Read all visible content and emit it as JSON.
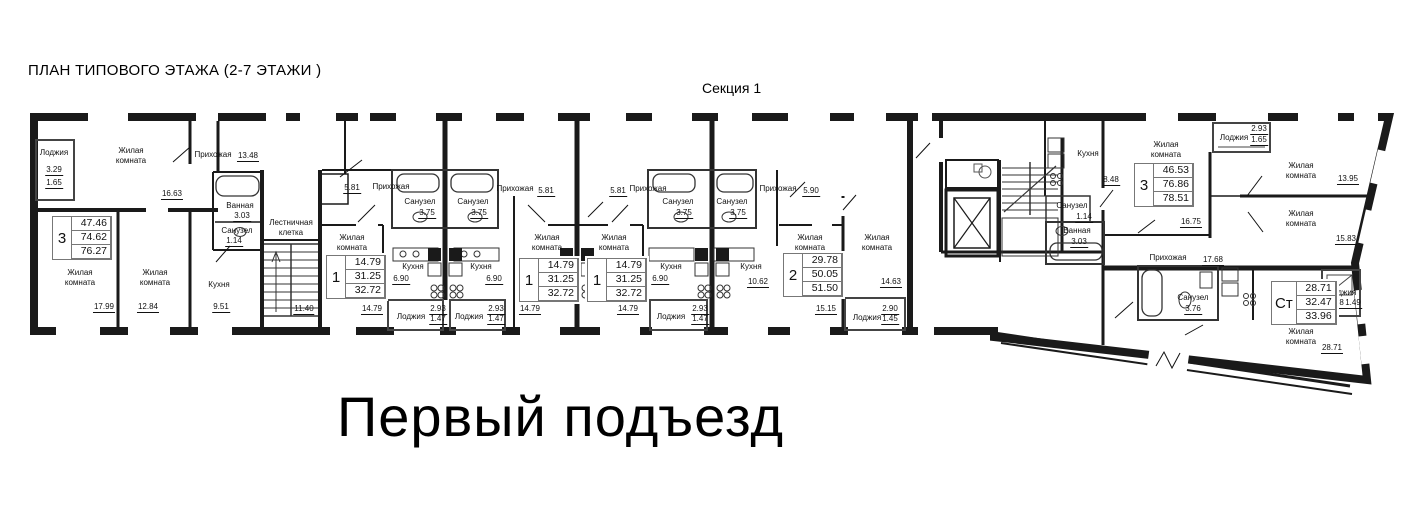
{
  "header": {
    "title": "ПЛАН ТИПОВОГО ЭТАЖА (2-7 ЭТАЖИ )",
    "section_label": "Секция 1"
  },
  "footer": {
    "entrance_label": "Первый подъезд"
  },
  "plan": {
    "rooms": [
      {
        "label": "Лоджия",
        "x": 54,
        "y": 148,
        "area": "3.29",
        "ax": 54,
        "ay": 166,
        "area2": "1.65",
        "a2x": 54,
        "a2y": 179
      },
      {
        "label": "Жилая\nкомната",
        "x": 131,
        "y": 146,
        "area": "16.63",
        "ax": 172,
        "ay": 190
      },
      {
        "label": "Прихожая",
        "x": 213,
        "y": 150,
        "area": "13.48",
        "ax": 248,
        "ay": 152
      },
      {
        "label": "Ванная",
        "x": 240,
        "y": 201,
        "area": "3.03",
        "ax": 242,
        "ay": 212
      },
      {
        "label": "Санузел",
        "x": 237,
        "y": 226,
        "area": "1.14",
        "ax": 234,
        "ay": 237
      },
      {
        "label": "Жилая\nкомната",
        "x": 80,
        "y": 268,
        "area": "17.99",
        "ax": 104,
        "ay": 303
      },
      {
        "label": "Жилая\nкомната",
        "x": 155,
        "y": 268,
        "area": "12.84",
        "ax": 148,
        "ay": 303
      },
      {
        "label": "Кухня",
        "x": 219,
        "y": 280,
        "area": "9.51",
        "ax": 221,
        "ay": 303
      },
      {
        "label": "Лестничная\nклетка",
        "x": 291,
        "y": 218,
        "area": "11.40",
        "ax": 304,
        "ay": 305
      },
      {
        "label": "Прихожая",
        "x": 391,
        "y": 182,
        "area": "5.81",
        "ax": 352,
        "ay": 184
      },
      {
        "label": "Жилая\nкомната",
        "x": 352,
        "y": 233,
        "area": "14.79",
        "ax": 372,
        "ay": 305
      },
      {
        "label": "Санузел",
        "x": 420,
        "y": 197,
        "area": "3.75",
        "ax": 427,
        "ay": 209
      },
      {
        "label": "Кухня",
        "x": 413,
        "y": 262,
        "area": "6.90",
        "ax": 401,
        "ay": 275
      },
      {
        "label": "Лоджия",
        "x": 411,
        "y": 312,
        "area": "2.93",
        "ax": 438,
        "ay": 305,
        "area2": "1.47",
        "a2x": 438,
        "a2y": 315
      },
      {
        "label": "Санузел",
        "x": 473,
        "y": 197,
        "area": "3.75",
        "ax": 479,
        "ay": 209
      },
      {
        "label": "Кухня",
        "x": 481,
        "y": 262,
        "area": "6.90",
        "ax": 494,
        "ay": 275
      },
      {
        "label": "Прихожая",
        "x": 515,
        "y": 184,
        "area": "5.81",
        "ax": 546,
        "ay": 187
      },
      {
        "label": "Жилая\nкомната",
        "x": 547,
        "y": 233,
        "area": "14.79",
        "ax": 530,
        "ay": 305
      },
      {
        "label": "Лоджия",
        "x": 469,
        "y": 312,
        "area": "2.93",
        "ax": 496,
        "ay": 305,
        "area2": "1.47",
        "a2x": 496,
        "a2y": 315
      },
      {
        "label": "Прихожая",
        "x": 648,
        "y": 184,
        "area": "5.81",
        "ax": 618,
        "ay": 187
      },
      {
        "label": "Жилая\nкомната",
        "x": 614,
        "y": 233,
        "area": "14.79",
        "ax": 628,
        "ay": 305
      },
      {
        "label": "Санузел",
        "x": 678,
        "y": 197,
        "area": "3.75",
        "ax": 684,
        "ay": 209
      },
      {
        "label": "Кухня",
        "x": 671,
        "y": 262,
        "area": "6.90",
        "ax": 660,
        "ay": 275
      },
      {
        "label": "Лоджия",
        "x": 671,
        "y": 312,
        "area": "2.93",
        "ax": 700,
        "ay": 305,
        "area2": "1.47",
        "a2x": 700,
        "a2y": 315
      },
      {
        "label": "Санузел",
        "x": 732,
        "y": 197,
        "area": "3.75",
        "ax": 738,
        "ay": 209
      },
      {
        "label": "Кухня",
        "x": 751,
        "y": 262,
        "area": "10.62",
        "ax": 758,
        "ay": 278
      },
      {
        "label": "Прихожая",
        "x": 778,
        "y": 184,
        "area": "5.90",
        "ax": 811,
        "ay": 187
      },
      {
        "label": "Жилая\nкомната",
        "x": 810,
        "y": 233,
        "area": "15.15",
        "ax": 826,
        "ay": 305
      },
      {
        "label": "Жилая\nкомната",
        "x": 877,
        "y": 233,
        "area": "14.63",
        "ax": 891,
        "ay": 278
      },
      {
        "label": "Лоджия",
        "x": 867,
        "y": 313,
        "area": "2.90",
        "ax": 890,
        "ay": 305,
        "area2": "1.45",
        "a2x": 890,
        "a2y": 315
      },
      {
        "label": "Кухня",
        "x": 1088,
        "y": 149,
        "area": "8.48",
        "ax": 1111,
        "ay": 176
      },
      {
        "label": "Санузел",
        "x": 1072,
        "y": 201,
        "area": "1.14",
        "ax": 1084,
        "ay": 213
      },
      {
        "label": "Ванная",
        "x": 1077,
        "y": 226,
        "area": "3.03",
        "ax": 1079,
        "ay": 238
      },
      {
        "label": "Жилая\nкомната",
        "x": 1166,
        "y": 140,
        "area": "16.75",
        "ax": 1191,
        "ay": 218
      },
      {
        "label": "Лоджия",
        "x": 1234,
        "y": 133,
        "area": "2.93",
        "ax": 1259,
        "ay": 125,
        "area2": "1.65",
        "a2x": 1259,
        "a2y": 136
      },
      {
        "label": "Прихожая",
        "x": 1168,
        "y": 253,
        "area": "17.68",
        "ax": 1213,
        "ay": 256
      },
      {
        "label": "Жилая\nкомната",
        "x": 1301,
        "y": 161,
        "area": "13.95",
        "ax": 1348,
        "ay": 175
      },
      {
        "label": "Жилая\nкомната",
        "x": 1301,
        "y": 209,
        "area": "15.83",
        "ax": 1346,
        "ay": 235
      },
      {
        "label": "Санузел",
        "x": 1193,
        "y": 293,
        "area": "3.76",
        "ax": 1193,
        "ay": 305
      },
      {
        "label": "Лоджия",
        "x": 1342,
        "y": 288,
        "area": "2.98",
        "ax": 1336,
        "ay": 299,
        "area2": "1.49",
        "a2x": 1353,
        "a2y": 299
      },
      {
        "label": "Жилая\nкомната",
        "x": 1301,
        "y": 327,
        "area": "28.71",
        "ax": 1332,
        "ay": 344
      }
    ],
    "apartments": [
      {
        "type": "3",
        "values": [
          "47.46",
          "74.62",
          "76.27"
        ],
        "x": 52,
        "y": 216
      },
      {
        "type": "1",
        "values": [
          "14.79",
          "31.25",
          "32.72"
        ],
        "x": 326,
        "y": 255
      },
      {
        "type": "1",
        "values": [
          "14.79",
          "31.25",
          "32.72"
        ],
        "x": 519,
        "y": 258
      },
      {
        "type": "1",
        "values": [
          "14.79",
          "31.25",
          "32.72"
        ],
        "x": 587,
        "y": 258
      },
      {
        "type": "2",
        "values": [
          "29.78",
          "50.05",
          "51.50"
        ],
        "x": 783,
        "y": 253
      },
      {
        "type": "3",
        "values": [
          "46.53",
          "76.86",
          "78.51"
        ],
        "x": 1134,
        "y": 163
      },
      {
        "type": "Ст",
        "values": [
          "28.71",
          "32.47",
          "33.96"
        ],
        "x": 1271,
        "y": 281
      }
    ]
  }
}
